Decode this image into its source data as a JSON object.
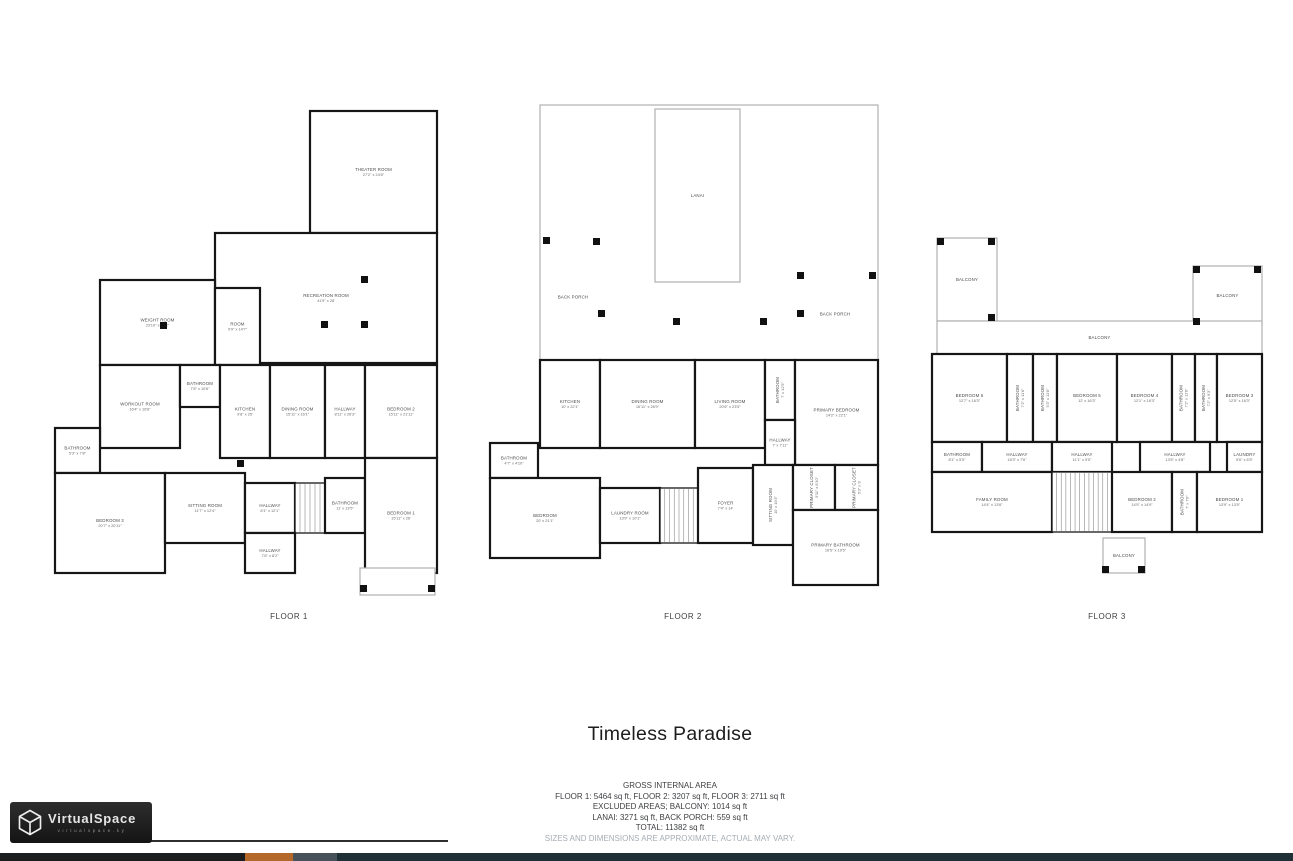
{
  "page": {
    "title": "Timeless Paradise",
    "area_summary": {
      "heading": "GROSS INTERNAL AREA",
      "lines": [
        "FLOOR 1: 5464 sq ft, FLOOR 2: 3207 sq ft, FLOOR 3: 2711 sq ft",
        "EXCLUDED AREAS; BALCONY: 1014 sq ft",
        "LANAI: 3271 sq ft, BACK PORCH: 559 sq ft",
        "TOTAL: 11382 sq ft"
      ],
      "disclaimer": "SIZES AND DIMENSIONS ARE APPROXIMATE, ACTUAL MAY VARY."
    }
  },
  "branding": {
    "logo_text": "VirtualSpace",
    "logo_subtext": "virtualspace.ky",
    "logo_icon": "cube-wireframe"
  },
  "colors": {
    "wall": "#161616",
    "outdoor_wall": "#b0b0b0",
    "room_label": "#4c4c4c",
    "accent_orange": "#b4682a",
    "bar_dark": "#1b1d1f",
    "bar_slate": "#47525a",
    "bar_teal": "#203037",
    "logo_bg": "#1e1e1e"
  },
  "bottom_bar": {
    "segments": [
      {
        "w": 245,
        "color": "#1b1d1f"
      },
      {
        "w": 48,
        "color": "#b4682a"
      },
      {
        "w": 44,
        "color": "#47525a"
      },
      {
        "w": 956,
        "color": "#203037"
      }
    ]
  },
  "floors": [
    {
      "label": "FLOOR 1",
      "rooms": [
        {
          "name": "THEATER ROOM",
          "dims": "27'2\" x 24'6\"",
          "x": 255,
          "y": 8,
          "w": 127,
          "h": 122
        },
        {
          "name": "RECREATION ROOM",
          "dims": "41'9\" x 28'",
          "x": 160,
          "y": 130,
          "w": 222,
          "h": 130
        },
        {
          "name": "WEIGHT ROOM",
          "dims": "23'10\" x 19'2\"",
          "x": 45,
          "y": 177,
          "w": 115,
          "h": 85
        },
        {
          "name": "ROOM",
          "dims": "9'9\" x 14'7\"",
          "x": 160,
          "y": 185,
          "w": 45,
          "h": 77
        },
        {
          "name": "WORKOUT ROOM",
          "dims": "16'4\" x 16'8\"",
          "x": 45,
          "y": 262,
          "w": 80,
          "h": 83
        },
        {
          "name": "BATHROOM",
          "dims": "7'8\" x 10'6\"",
          "x": 125,
          "y": 262,
          "w": 40,
          "h": 42
        },
        {
          "name": "KITCHEN",
          "dims": "9'8\" x 25'",
          "x": 165,
          "y": 262,
          "w": 50,
          "h": 93
        },
        {
          "name": "DINING ROOM",
          "dims": "15'11\" x 16'1\"",
          "x": 215,
          "y": 262,
          "w": 55,
          "h": 93
        },
        {
          "name": "HALLWAY",
          "dims": "8'11\" x 26'3\"",
          "x": 270,
          "y": 262,
          "w": 40,
          "h": 93
        },
        {
          "name": "BEDROOM 2",
          "dims": "15'11\" x 21'11\"",
          "x": 310,
          "y": 262,
          "w": 72,
          "h": 93
        },
        {
          "name": "BATHROOM",
          "dims": "5'3\" x 7'8\"",
          "x": 0,
          "y": 325,
          "w": 45,
          "h": 45
        },
        {
          "name": "BEDROOM 3",
          "dims": "20'7\" x 20'11\"",
          "x": 0,
          "y": 370,
          "w": 110,
          "h": 100
        },
        {
          "name": "SITTING ROOM",
          "dims": "11'7\" x 12'4\"",
          "x": 110,
          "y": 370,
          "w": 80,
          "h": 70
        },
        {
          "name": "HALLWAY",
          "dims": "8'1\" x 12'1\"",
          "x": 190,
          "y": 380,
          "w": 50,
          "h": 50
        },
        {
          "kind": "stairs",
          "x": 240,
          "y": 380,
          "w": 30,
          "h": 50
        },
        {
          "name": "BATHROOM",
          "dims": "11' x 13'5\"",
          "x": 270,
          "y": 375,
          "w": 40,
          "h": 55
        },
        {
          "name": "BEDROOM 1",
          "dims": "15'11\" x 26'",
          "x": 310,
          "y": 355,
          "w": 72,
          "h": 115
        },
        {
          "name": "HALLWAY",
          "dims": "7'6\" x 8'2\"",
          "x": 190,
          "y": 430,
          "w": 50,
          "h": 40
        },
        {
          "kind": "outdoor",
          "x": 305,
          "y": 465,
          "w": 75,
          "h": 27
        }
      ],
      "posts": [
        [
          306,
          173
        ],
        [
          266,
          218
        ],
        [
          306,
          218
        ],
        [
          105,
          219
        ],
        [
          182,
          357
        ],
        [
          305,
          482
        ],
        [
          373,
          482
        ]
      ]
    },
    {
      "label": "FLOOR 2",
      "rooms": [
        {
          "kind": "outdoor",
          "x": 52,
          "y": 2,
          "w": 338,
          "h": 255
        },
        {
          "kind": "outdoor",
          "name": "LANAI",
          "x": 167,
          "y": 6,
          "w": 85,
          "h": 173
        },
        {
          "kind": "label",
          "name": "BACK PORCH",
          "x": 55,
          "y": 185,
          "w": 60,
          "h": 18
        },
        {
          "kind": "label",
          "name": "BACK PORCH",
          "x": 317,
          "y": 202,
          "w": 60,
          "h": 18
        },
        {
          "name": "KITCHEN",
          "dims": "10' x 22'1\"",
          "x": 52,
          "y": 257,
          "w": 60,
          "h": 88
        },
        {
          "name": "DINING ROOM",
          "dims": "16'11\" x 26'9\"",
          "x": 112,
          "y": 257,
          "w": 95,
          "h": 88
        },
        {
          "name": "LIVING ROOM",
          "dims": "20'6\" x 23'5\"",
          "x": 207,
          "y": 257,
          "w": 70,
          "h": 88
        },
        {
          "name": "BATHROOM",
          "dims": "7' x 12'5\"",
          "x": 277,
          "y": 257,
          "w": 30,
          "h": 60,
          "vertical": true
        },
        {
          "name": "PRIMARY BEDROOM",
          "dims": "14'2\" x 22'1\"",
          "x": 307,
          "y": 257,
          "w": 83,
          "h": 105
        },
        {
          "name": "HALLWAY",
          "dims": "7' x 7'11\"",
          "x": 277,
          "y": 317,
          "w": 30,
          "h": 45
        },
        {
          "name": "BATHROOM",
          "dims": "4'7\" x 4'10\"",
          "x": 2,
          "y": 340,
          "w": 48,
          "h": 35
        },
        {
          "name": "BEDROOM",
          "dims": "20' x 21'1\"",
          "x": 2,
          "y": 375,
          "w": 110,
          "h": 80
        },
        {
          "name": "LAUNDRY ROOM",
          "dims": "13'9\" x 10'1\"",
          "x": 112,
          "y": 385,
          "w": 60,
          "h": 55
        },
        {
          "kind": "stairs",
          "x": 172,
          "y": 385,
          "w": 38,
          "h": 55
        },
        {
          "name": "FOYER",
          "dims": "7'4\" x 14'",
          "x": 210,
          "y": 365,
          "w": 55,
          "h": 75
        },
        {
          "name": "SITTING ROOM",
          "dims": "10' x 19'3\"",
          "x": 265,
          "y": 362,
          "w": 40,
          "h": 80,
          "vertical": true
        },
        {
          "name": "PRIMARY CLOSET",
          "dims": "5'11\" x 8'10\"",
          "x": 305,
          "y": 362,
          "w": 42,
          "h": 45,
          "vertical": true
        },
        {
          "name": "PRIMARY CLOSET",
          "dims": "5'3\" x 9'",
          "x": 347,
          "y": 362,
          "w": 43,
          "h": 45,
          "vertical": true
        },
        {
          "name": "PRIMARY BATHROOM",
          "dims": "16'5\" x 19'5\"",
          "x": 305,
          "y": 407,
          "w": 85,
          "h": 75
        }
      ],
      "posts": [
        [
          55,
          134
        ],
        [
          105,
          135
        ],
        [
          309,
          169
        ],
        [
          381,
          169
        ],
        [
          110,
          207
        ],
        [
          185,
          215
        ],
        [
          272,
          215
        ],
        [
          309,
          207
        ]
      ]
    },
    {
      "label": "FLOOR 3",
      "rooms": [
        {
          "kind": "outdoor",
          "name": "BALCONY",
          "x": 7,
          "y": 10,
          "w": 60,
          "h": 83
        },
        {
          "kind": "outdoor",
          "name": "BALCONY",
          "x": 263,
          "y": 38,
          "w": 69,
          "h": 59
        },
        {
          "kind": "outdoor",
          "name": "BALCONY",
          "x": 7,
          "y": 93,
          "w": 325,
          "h": 33
        },
        {
          "name": "BEDROOM 6",
          "dims": "12'7\" x 16'3\"",
          "x": 2,
          "y": 126,
          "w": 75,
          "h": 88
        },
        {
          "name": "BATHROOM",
          "dims": "7'2\" x 11'8\"",
          "x": 77,
          "y": 126,
          "w": 26,
          "h": 88,
          "vertical": true
        },
        {
          "name": "BATHROOM",
          "dims": "5'3\" x 11'8\"",
          "x": 103,
          "y": 126,
          "w": 24,
          "h": 88,
          "vertical": true
        },
        {
          "name": "BEDROOM 5",
          "dims": "12' x 16'3\"",
          "x": 127,
          "y": 126,
          "w": 60,
          "h": 88
        },
        {
          "name": "BEDROOM 4",
          "dims": "12'1\" x 16'3\"",
          "x": 187,
          "y": 126,
          "w": 55,
          "h": 88
        },
        {
          "name": "BATHROOM",
          "dims": "7'2\" x 11'8\"",
          "x": 242,
          "y": 126,
          "w": 23,
          "h": 88,
          "vertical": true
        },
        {
          "name": "BATHROOM",
          "dims": "7'2\" x 9'3\"",
          "x": 265,
          "y": 126,
          "w": 22,
          "h": 88,
          "vertical": true
        },
        {
          "name": "BEDROOM 3",
          "dims": "12'5\" x 16'3\"",
          "x": 287,
          "y": 126,
          "w": 45,
          "h": 88
        },
        {
          "name": "BATHROOM",
          "dims": "8'1\" x 5'5\"",
          "x": 2,
          "y": 214,
          "w": 50,
          "h": 30
        },
        {
          "name": "HALLWAY",
          "dims": "16'3\" x 7'6\"",
          "x": 52,
          "y": 214,
          "w": 70,
          "h": 30
        },
        {
          "name": "HALLWAY",
          "dims": "11'1\" x 5'5\"",
          "x": 122,
          "y": 214,
          "w": 60,
          "h": 30
        },
        {
          "name": "HALLWAY",
          "dims": "13'5\" x 4'8\"",
          "x": 210,
          "y": 214,
          "w": 70,
          "h": 30
        },
        {
          "name": "LAUNDRY",
          "dims": "5'6\" x 6'5\"",
          "x": 297,
          "y": 214,
          "w": 35,
          "h": 30
        },
        {
          "name": "FAMILY ROOM",
          "dims": "14'4\" x 13'6\"",
          "x": 2,
          "y": 244,
          "w": 120,
          "h": 60
        },
        {
          "kind": "stairs",
          "x": 122,
          "y": 244,
          "w": 60,
          "h": 60
        },
        {
          "name": "BEDROOM 2",
          "dims": "14'5\" x 14'9\"",
          "x": 182,
          "y": 244,
          "w": 60,
          "h": 60
        },
        {
          "name": "BATHROOM",
          "dims": "7' x 7'6\"",
          "x": 242,
          "y": 244,
          "w": 25,
          "h": 60,
          "vertical": true
        },
        {
          "name": "BEDROOM 1",
          "dims": "13'9\" x 13'5\"",
          "x": 267,
          "y": 244,
          "w": 65,
          "h": 60
        },
        {
          "kind": "outdoor",
          "name": "BALCONY",
          "x": 173,
          "y": 310,
          "w": 42,
          "h": 35
        }
      ],
      "posts": [
        [
          7,
          10
        ],
        [
          58,
          10
        ],
        [
          58,
          86
        ],
        [
          263,
          38
        ],
        [
          324,
          38
        ],
        [
          263,
          90
        ],
        [
          172,
          338
        ],
        [
          208,
          338
        ]
      ]
    }
  ]
}
